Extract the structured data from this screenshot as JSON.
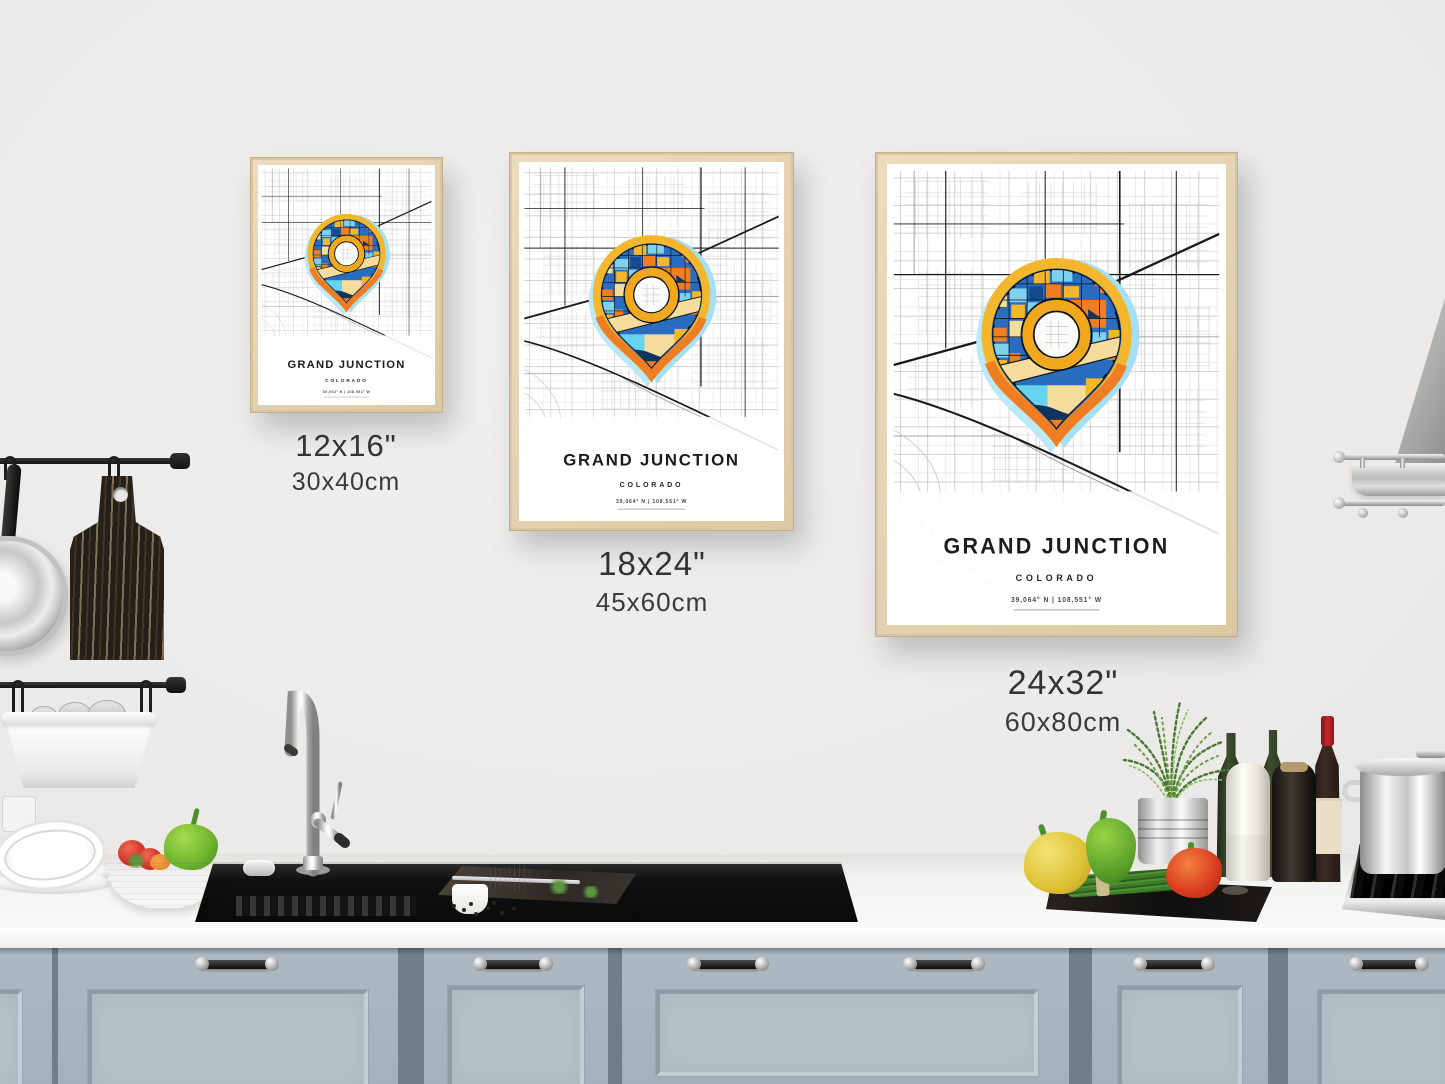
{
  "poster": {
    "title": "GRAND JUNCTION",
    "subtitle": "COLORADO",
    "coordinates": "39,064° N | 108,551° W"
  },
  "size_labels": [
    {
      "inches": "12x16\"",
      "cm": "30x40cm"
    },
    {
      "inches": "18x24\"",
      "cm": "45x60cm"
    },
    {
      "inches": "24x32\"",
      "cm": "60x80cm"
    }
  ],
  "palette": {
    "wall": "#ebeae8",
    "cabinet": "#a9b5be",
    "counter": "#f6f6f4",
    "frame_wood": "#e3d2b0",
    "pin_yellow": "#f4b62c",
    "pin_orange": "#ef7d22",
    "pin_blue": "#2a6cc0",
    "pin_light_blue": "#7fd2ee",
    "pin_cream": "#f4dc9c",
    "pin_halo": "#a5dff3"
  }
}
